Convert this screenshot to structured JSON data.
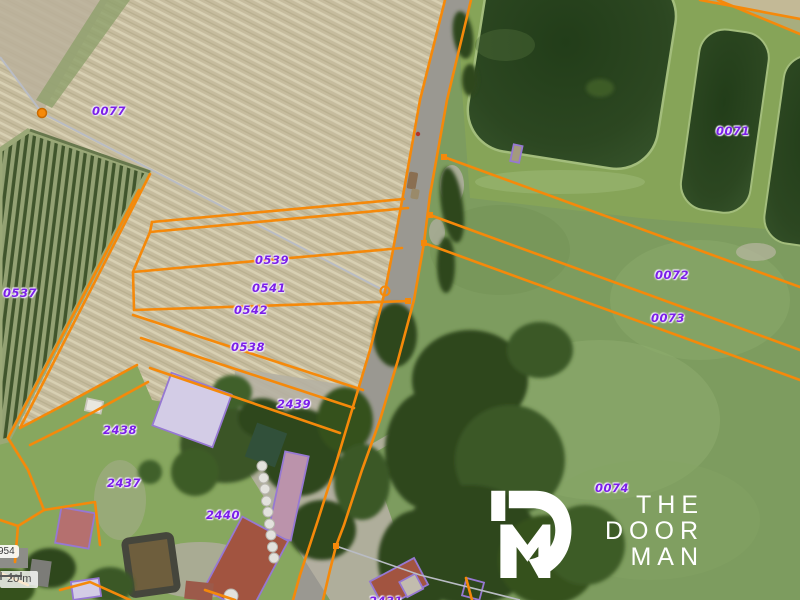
{
  "map": {
    "parcel_labels": [
      {
        "id": "0077",
        "x": 109,
        "y": 111
      },
      {
        "id": "0537",
        "x": 20,
        "y": 293
      },
      {
        "id": "0539",
        "x": 272,
        "y": 260
      },
      {
        "id": "0541",
        "x": 269,
        "y": 288
      },
      {
        "id": "0542",
        "x": 251,
        "y": 310
      },
      {
        "id": "0538",
        "x": 248,
        "y": 347
      },
      {
        "id": "2439",
        "x": 294,
        "y": 404
      },
      {
        "id": "2438",
        "x": 120,
        "y": 430
      },
      {
        "id": "2437",
        "x": 124,
        "y": 483
      },
      {
        "id": "2440",
        "x": 223,
        "y": 515
      },
      {
        "id": "0071",
        "x": 733,
        "y": 131
      },
      {
        "id": "0072",
        "x": 672,
        "y": 275
      },
      {
        "id": "0073",
        "x": 668,
        "y": 318
      },
      {
        "id": "0074",
        "x": 612,
        "y": 488
      },
      {
        "id": "2431",
        "x": 386,
        "y": 601
      }
    ],
    "boundary_markers": [
      {
        "type": "filled-circle",
        "x": 42,
        "y": 113
      },
      {
        "type": "open-circle",
        "x": 385,
        "y": 291
      },
      {
        "type": "square",
        "x": 444,
        "y": 157
      },
      {
        "type": "square",
        "x": 430,
        "y": 215
      },
      {
        "type": "square",
        "x": 424,
        "y": 243
      },
      {
        "type": "square",
        "x": 408,
        "y": 301
      },
      {
        "type": "square",
        "x": 336,
        "y": 546
      }
    ],
    "reference_label": "954",
    "scale_bar": {
      "distance_label": "20 m"
    }
  },
  "logo": {
    "line1": "THE",
    "line2": "DOOR",
    "line3": "MAN",
    "icon": "doorman-dm-monogram"
  },
  "colors": {
    "parcel_line": "#F5890A",
    "parcel_label": "#7B1FE8",
    "building_outline": "#9678D2",
    "survey_line": "#B9BCC4",
    "road": "#9A9891",
    "pond_water": "#2C4721",
    "pasture": "#7D9C5F",
    "field": "#C6BC9E",
    "logo": "#FFFFFF"
  }
}
